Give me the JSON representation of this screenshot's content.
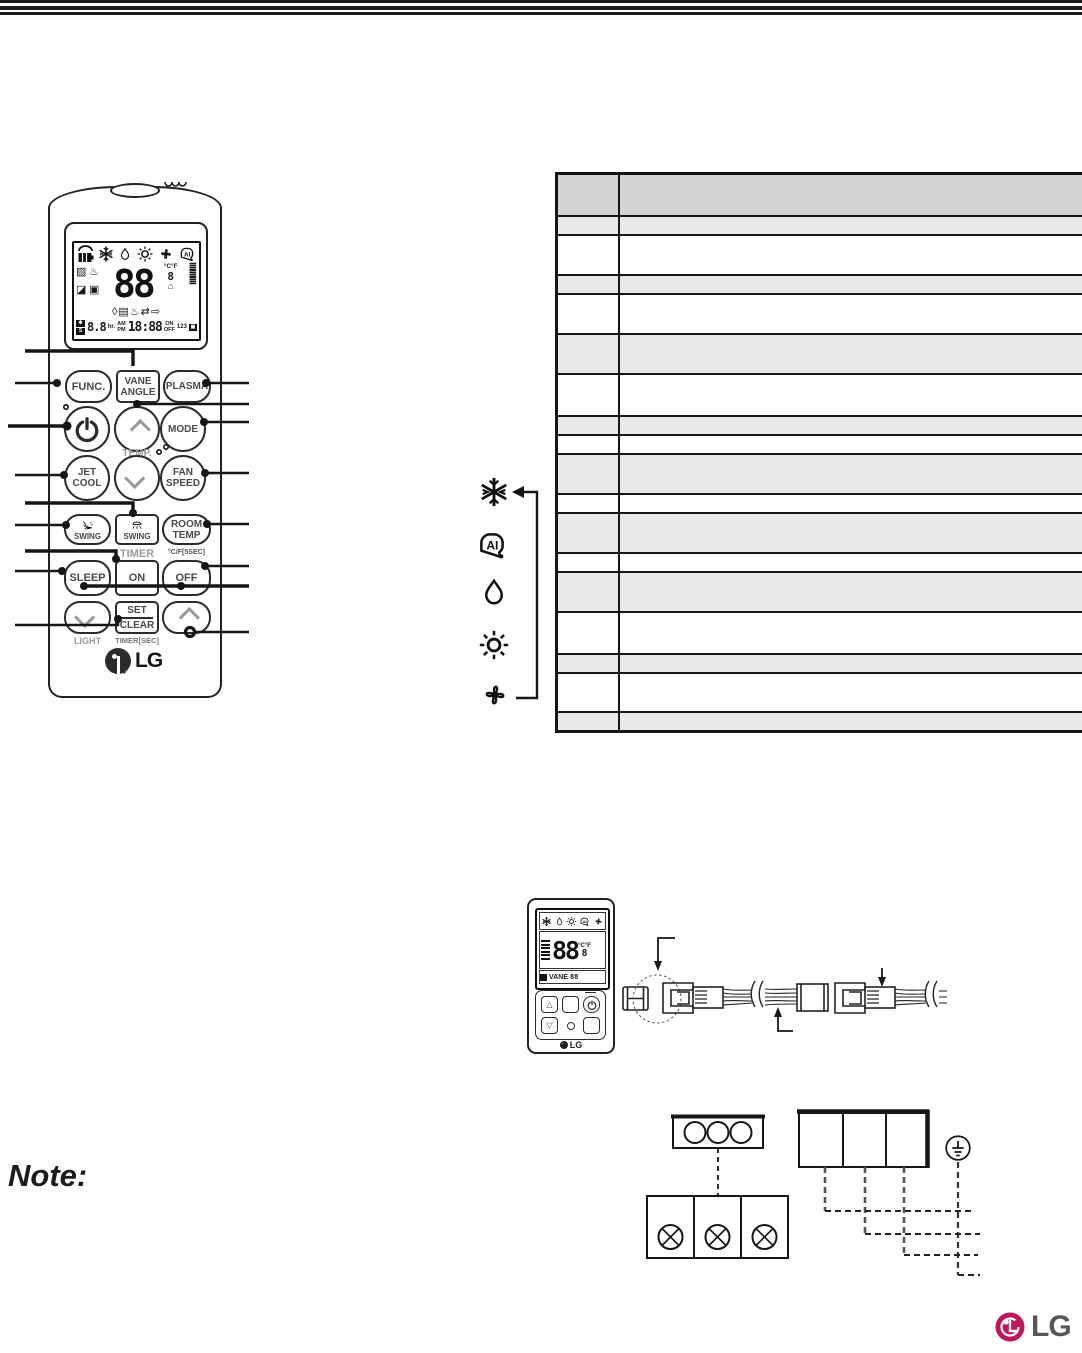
{
  "page": {
    "note_label": "Note:"
  },
  "colors": {
    "lg_magenta": "#c1155b",
    "lg_gray": "#57575a",
    "table_header": "#d4d4d4",
    "table_shaded": "#e9e9e9"
  },
  "handheld_remote": {
    "logo": "LG",
    "buttons": {
      "func": "FUNC.",
      "vane_line1": "VANE",
      "vane_line2": "ANGLE",
      "plasma": "PLASMA",
      "mode": "MODE",
      "jet_line1": "JET",
      "jet_line2": "COOL",
      "fan_line1": "FAN",
      "fan_line2": "SPEED",
      "swing_left": "SWING",
      "swing_right": "SWING",
      "room_line1": "ROOM",
      "room_line2": "TEMP",
      "sleep": "SLEEP",
      "timer_on": "ON",
      "timer_off": "OFF",
      "set": "SET",
      "clear": "CLEAR"
    },
    "labels": {
      "temp": "TEMP.",
      "timer": "TIMER",
      "room_temp_hold": "°C/F[5SEC]",
      "light": "LIGHT",
      "timer_sec": "TIMER[SEC]"
    },
    "lcd": {
      "big_digits": "88",
      "small_digit": "8",
      "deg_c": "°C",
      "deg_f": "°F",
      "row3_glyphs": "◊▤♨⇄⇨",
      "left_glyphs_1": "▨",
      "left_glyphs_2": "♨",
      "left_glyphs_3": "◪",
      "left_glyphs_4": "▣",
      "house": "⌂",
      "bars": "≣",
      "s_flag": "S",
      "star_flag": "✱",
      "hr_digits": "8.8",
      "hr_unit": "hr.",
      "am": "AM",
      "pm": "PM",
      "clock": "18:88",
      "on": "ON",
      "off": "OFF",
      "nums": "123",
      "cal": "▣"
    }
  },
  "mode_icons": [
    "snowflake-icon",
    "ai-icon",
    "drop-icon",
    "sun-icon",
    "fan-icon"
  ],
  "table": {
    "rows": [
      {
        "shade": "header",
        "h": 42,
        "c1": "",
        "c2": ""
      },
      {
        "shade": "g",
        "h": 19,
        "c1": "",
        "c2": ""
      },
      {
        "shade": "w",
        "h": 40,
        "c1": "",
        "c2": ""
      },
      {
        "shade": "g",
        "h": 19,
        "c1": "",
        "c2": ""
      },
      {
        "shade": "w",
        "h": 40,
        "c1": "",
        "c2": ""
      },
      {
        "shade": "g",
        "h": 40,
        "c1": "",
        "c2": ""
      },
      {
        "shade": "w",
        "h": 42,
        "c1": "",
        "c2": ""
      },
      {
        "shade": "g",
        "h": 19,
        "c1": "",
        "c2": ""
      },
      {
        "shade": "w",
        "h": 19,
        "c1": "",
        "c2": ""
      },
      {
        "shade": "g",
        "h": 40,
        "c1": "",
        "c2": ""
      },
      {
        "shade": "w",
        "h": 19,
        "c1": "",
        "c2": ""
      },
      {
        "shade": "g",
        "h": 40,
        "c1": "",
        "c2": ""
      },
      {
        "shade": "w",
        "h": 19,
        "c1": "",
        "c2": ""
      },
      {
        "shade": "g",
        "h": 40,
        "c1": "",
        "c2": ""
      },
      {
        "shade": "w",
        "h": 42,
        "c1": "",
        "c2": ""
      },
      {
        "shade": "g",
        "h": 19,
        "c1": "",
        "c2": ""
      },
      {
        "shade": "w",
        "h": 39,
        "c1": "",
        "c2": ""
      },
      {
        "shade": "g",
        "h": 20,
        "c1": "",
        "c2": ""
      }
    ]
  },
  "wired_remote": {
    "big_digits": "88",
    "small_digit": "8",
    "deg": "°C°F",
    "vane": "VANE",
    "vane_digits": "88",
    "btn_up": "△",
    "btn_down": "▽",
    "logo": "LG"
  },
  "footer": {
    "logo": "LG"
  }
}
